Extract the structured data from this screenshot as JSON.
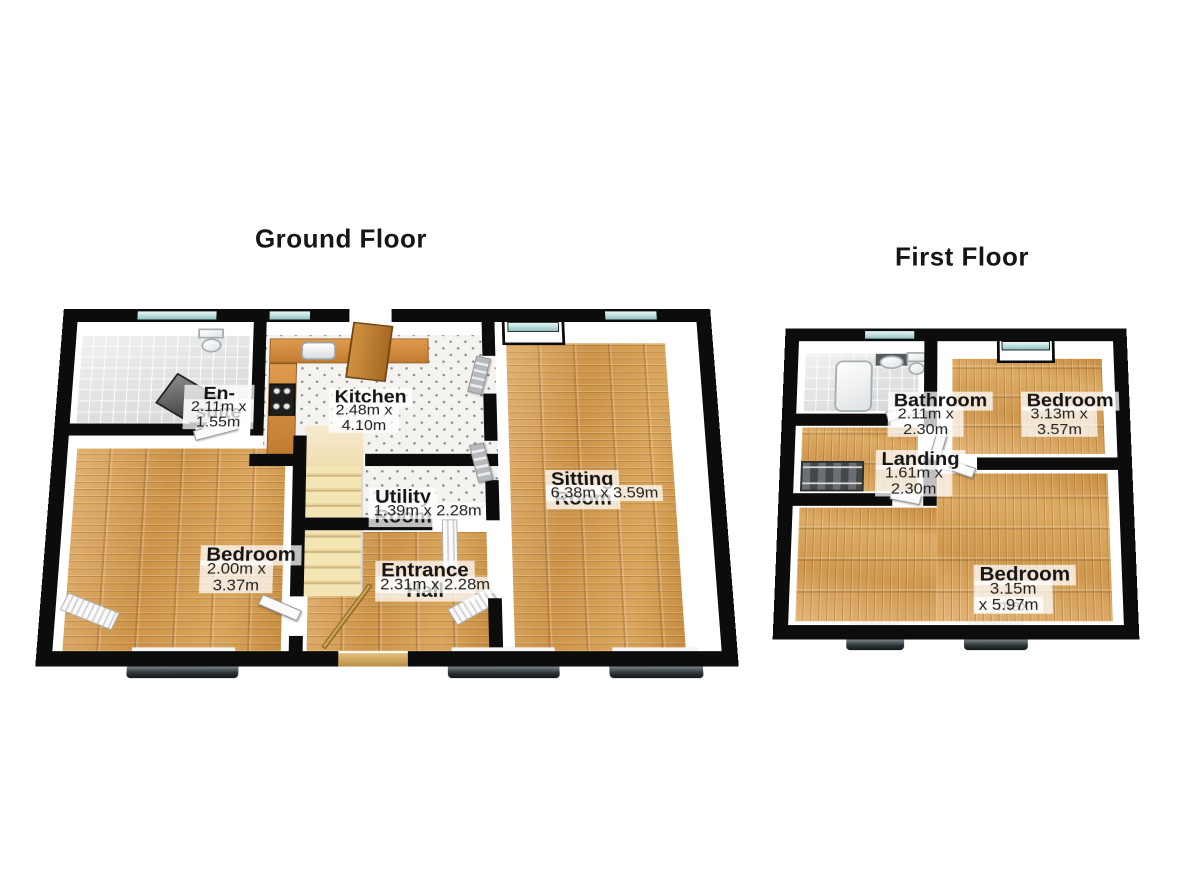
{
  "page": {
    "background_color": "#ffffff",
    "type": "3d-floorplan"
  },
  "floors": [
    {
      "title": "Ground Floor",
      "rooms": [
        {
          "name": "En-suite",
          "dimensions": "2.11m x 1.55m"
        },
        {
          "name": "Kitchen",
          "dimensions": "2.48m x 4.10m"
        },
        {
          "name": "Sitting Room",
          "dimensions": "6.38m x 3.59m"
        },
        {
          "name": "Utility Room",
          "dimensions": "1.39m x 2.28m"
        },
        {
          "name": "Bedroom",
          "dimensions": "2.00m x 3.37m"
        },
        {
          "name": "Entrance Hall",
          "dimensions": "2.31m x 2.28m"
        }
      ]
    },
    {
      "title": "First Floor",
      "rooms": [
        {
          "name": "Bathroom",
          "dimensions": "2.11m x 2.30m"
        },
        {
          "name": "Bedroom",
          "dimensions": "3.13m x 3.57m"
        },
        {
          "name": "Landing",
          "dimensions": "1.61m x 2.30m"
        },
        {
          "name": "Bedroom",
          "dimensions_lines": [
            "3.15m max",
            "x 5.97m"
          ]
        }
      ]
    }
  ],
  "colors": {
    "wall": "#0c0c0c",
    "wood_floor": "#d29a52",
    "tile_floor": "#e6e6e6",
    "window_glass": "#bfe0dd",
    "door_wood": "#b5762e",
    "stairs": "#f0e0ae",
    "label_background": "rgba(255,255,255,0.74)",
    "text": "#141414"
  }
}
